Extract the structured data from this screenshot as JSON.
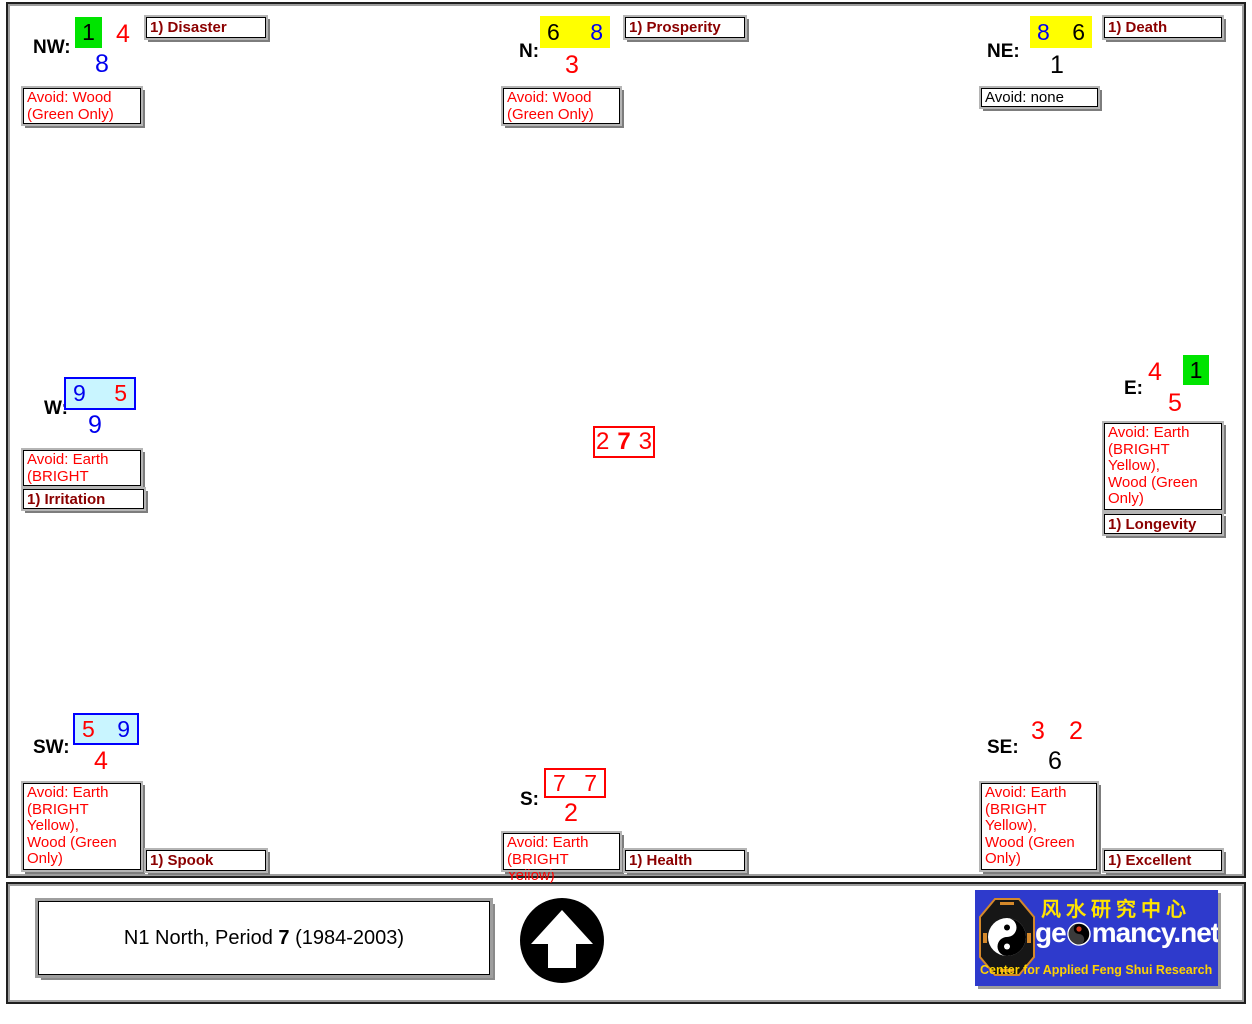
{
  "chart": {
    "center": {
      "left": "2",
      "middle": "7",
      "right": "3"
    },
    "sectors": {
      "nw": {
        "label": "NW:",
        "box_num": "1",
        "num_right": "4",
        "num_below": "8",
        "avoid_lines": [
          "Avoid: Wood",
          "(Green Only)"
        ],
        "tag": "1) Disaster"
      },
      "n": {
        "label": "N:",
        "box_nums": [
          "6",
          "8"
        ],
        "num_below": "3",
        "avoid_lines": [
          "Avoid: Wood",
          "(Green Only)"
        ],
        "tag": "1) Prosperity"
      },
      "ne": {
        "label": "NE:",
        "box_nums": [
          "8",
          "6"
        ],
        "num_below": "1",
        "avoid_lines": [
          "Avoid: none"
        ],
        "tag": "1) Death"
      },
      "w": {
        "label": "W:",
        "box_nums": [
          "9",
          "5"
        ],
        "num_below": "9",
        "avoid_lines": [
          "Avoid: Earth",
          "(BRIGHT Yellow)"
        ],
        "tag": "1) Irritation"
      },
      "e": {
        "label": "E:",
        "num_left": "4",
        "box_num": "1",
        "num_below": "5",
        "avoid_lines": [
          "Avoid: Earth",
          "(BRIGHT",
          "Yellow),",
          "Wood (Green",
          "Only)"
        ],
        "tag": "1) Longevity"
      },
      "sw": {
        "label": "SW:",
        "box_nums": [
          "5",
          "9"
        ],
        "num_below": "4",
        "avoid_lines": [
          "Avoid: Earth",
          "(BRIGHT",
          "Yellow),",
          "Wood (Green",
          "Only)"
        ],
        "tag": "1) Spook"
      },
      "s": {
        "label": "S:",
        "box_nums": [
          "7",
          "7"
        ],
        "num_below": "2",
        "avoid_lines": [
          "Avoid: Earth",
          "(BRIGHT Yellow)"
        ],
        "tag": "1) Health"
      },
      "se": {
        "label": "SE:",
        "num_left": "3",
        "num_right": "2",
        "num_below": "6",
        "avoid_lines": [
          "Avoid: Earth",
          "(BRIGHT",
          "Yellow),",
          "Wood (Green",
          "Only)"
        ],
        "tag": "1) Excellent"
      }
    }
  },
  "footer": {
    "title_pre": "N1 North, Period ",
    "title_bold": "7",
    "title_post": " (1984-2003)",
    "logo": {
      "chinese": "风水研究中心",
      "wordmark_left": "ge",
      "wordmark_right": "mancy.net",
      "tagline": "Center for Applied Feng Shui Research"
    }
  },
  "colors": {
    "star_green": "#00e400",
    "star_yellow": "#ffff00",
    "star_cyan": "#c9f5ff",
    "star_red": "#ff0000",
    "num_blue": "#0000ee",
    "tag_dark_red": "#8b0000",
    "logo_blue": "#2e3acc"
  }
}
